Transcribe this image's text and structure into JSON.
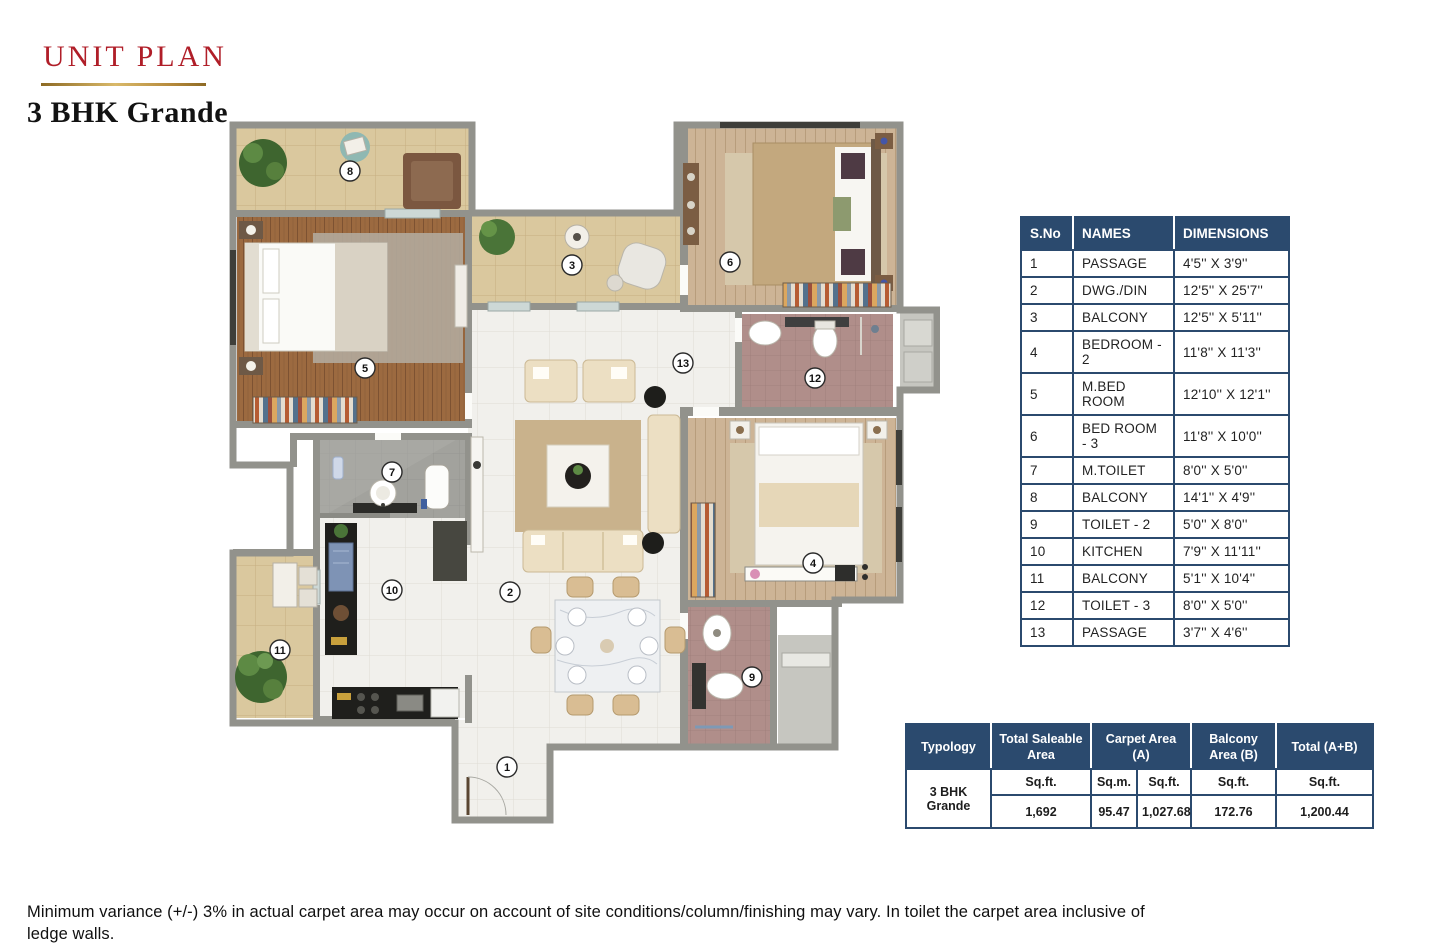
{
  "page": {
    "title_small": "UNIT PLAN",
    "title_main": "3 BHK Grande",
    "footer_line1": "Minimum variance (+/-) 3% in actual carpet area may occur on account of site conditions/column/finishing may vary. In toilet the carpet area inclusive of ledge walls.",
    "footer_line2": "Floor Plan is for space planning purpose only."
  },
  "colors": {
    "accent_red": "#b01e28",
    "gold": "#c29a4a",
    "table_navy": "#2b4a6e",
    "wall_gray": "#92928c",
    "balcony_tan": "#dac89e",
    "master_bed_wood": "#9c6a40",
    "bedroom_wood": "#cdb496",
    "toilet_mauve": "#b08e8a",
    "floor_white": "#f1f0ec"
  },
  "dimensions_table": {
    "headers": [
      "S.No",
      "NAMES",
      "DIMENSIONS"
    ],
    "rows": [
      [
        "1",
        "PASSAGE",
        "4'5'' X 3'9''"
      ],
      [
        "2",
        "DWG./DIN",
        "12'5'' X 25'7''"
      ],
      [
        "3",
        "BALCONY",
        "12'5'' X  5'11''"
      ],
      [
        "4",
        "BEDROOM - 2",
        "11'8'' X 11'3''"
      ],
      [
        "5",
        "M.BED ROOM",
        "12'10'' X 12'1''"
      ],
      [
        "6",
        "BED ROOM - 3",
        "11'8'' X 10'0''"
      ],
      [
        "7",
        "M.TOILET",
        "8'0'' X  5'0''"
      ],
      [
        "8",
        "BALCONY",
        "14'1'' X 4'9''"
      ],
      [
        "9",
        "TOILET - 2",
        "5'0'' X 8'0''"
      ],
      [
        "10",
        "KITCHEN",
        "7'9'' X 11'11''"
      ],
      [
        "11",
        "BALCONY",
        "5'1'' X 10'4''"
      ],
      [
        "12",
        "TOILET - 3",
        "8'0'' X 5'0''"
      ],
      [
        "13",
        "PASSAGE",
        "3'7'' X 4'6''"
      ]
    ]
  },
  "area_table": {
    "headers": {
      "typology": "Typology",
      "saleable": "Total Saleable Area",
      "carpet": "Carpet Area (A)",
      "balcony": "Balcony Area (B)",
      "total": "Total (A+B)"
    },
    "typology_value": "3 BHK Grande",
    "units": {
      "saleable": "Sq.ft.",
      "carpet_m": "Sq.m.",
      "carpet_ft": "Sq.ft.",
      "balcony": "Sq.ft.",
      "total": "Sq.ft."
    },
    "values": {
      "saleable": "1,692",
      "carpet_m": "95.47",
      "carpet_ft": "1,027.68",
      "balcony": "172.76",
      "total": "1,200.44"
    }
  },
  "floorplan": {
    "room_numbers": [
      "1",
      "2",
      "3",
      "4",
      "5",
      "6",
      "7",
      "8",
      "9",
      "10",
      "11",
      "12",
      "13"
    ]
  }
}
